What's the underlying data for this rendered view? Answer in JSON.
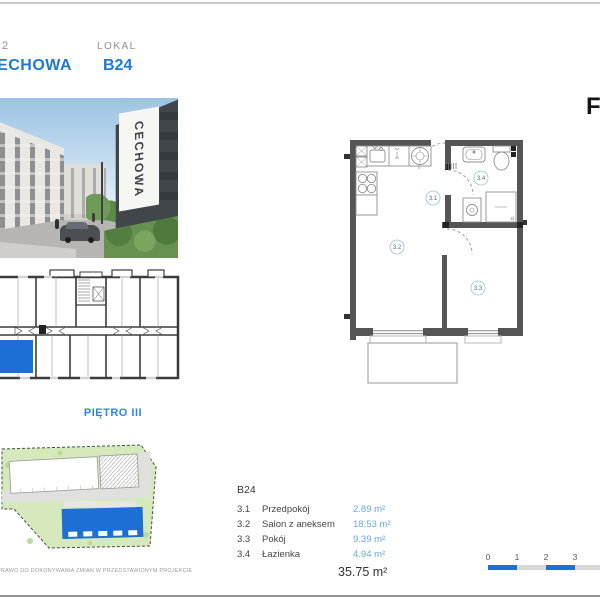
{
  "header": {
    "stage": "2",
    "project_name": "CECHOWA",
    "lokal_label": "LOKAL",
    "unit_number": "B24"
  },
  "logo": {
    "letter": "F"
  },
  "photo": {
    "building_sign": "CECHOWA"
  },
  "floor_label": "PIĘTRO III",
  "floor_plan": {
    "labels": {
      "hall": "3.1",
      "living": "3.2",
      "room": "3.3",
      "bath": "3.4"
    }
  },
  "legend": {
    "unit": "B24",
    "rows": [
      {
        "no": "3.1",
        "name": "Przedpokój",
        "area": "2.89 m²"
      },
      {
        "no": "3.2",
        "name": "Salon z aneksem",
        "area": "18.53 m²"
      },
      {
        "no": "3.3",
        "name": "Pokój",
        "area": "9.39 m²"
      },
      {
        "no": "3.4",
        "name": "Łazienka",
        "area": "4.94 m²"
      }
    ],
    "total": "35.75 m²"
  },
  "scale_bar": {
    "ticks": [
      "0",
      "1",
      "2",
      "3"
    ]
  },
  "disclaimer": "PRAWO DO DOKONYWANIA ZMIAN W PRZEDSTAWIONYM PROJEKCIE",
  "colors": {
    "accent_blue": "#1e78d2",
    "highlight_blue": "#1d6fd3",
    "area_text_blue": "#66a9e0",
    "scale_blue": "#1e6fd0",
    "wall_gray": "#555555",
    "site_green": "#d6e9bd"
  }
}
